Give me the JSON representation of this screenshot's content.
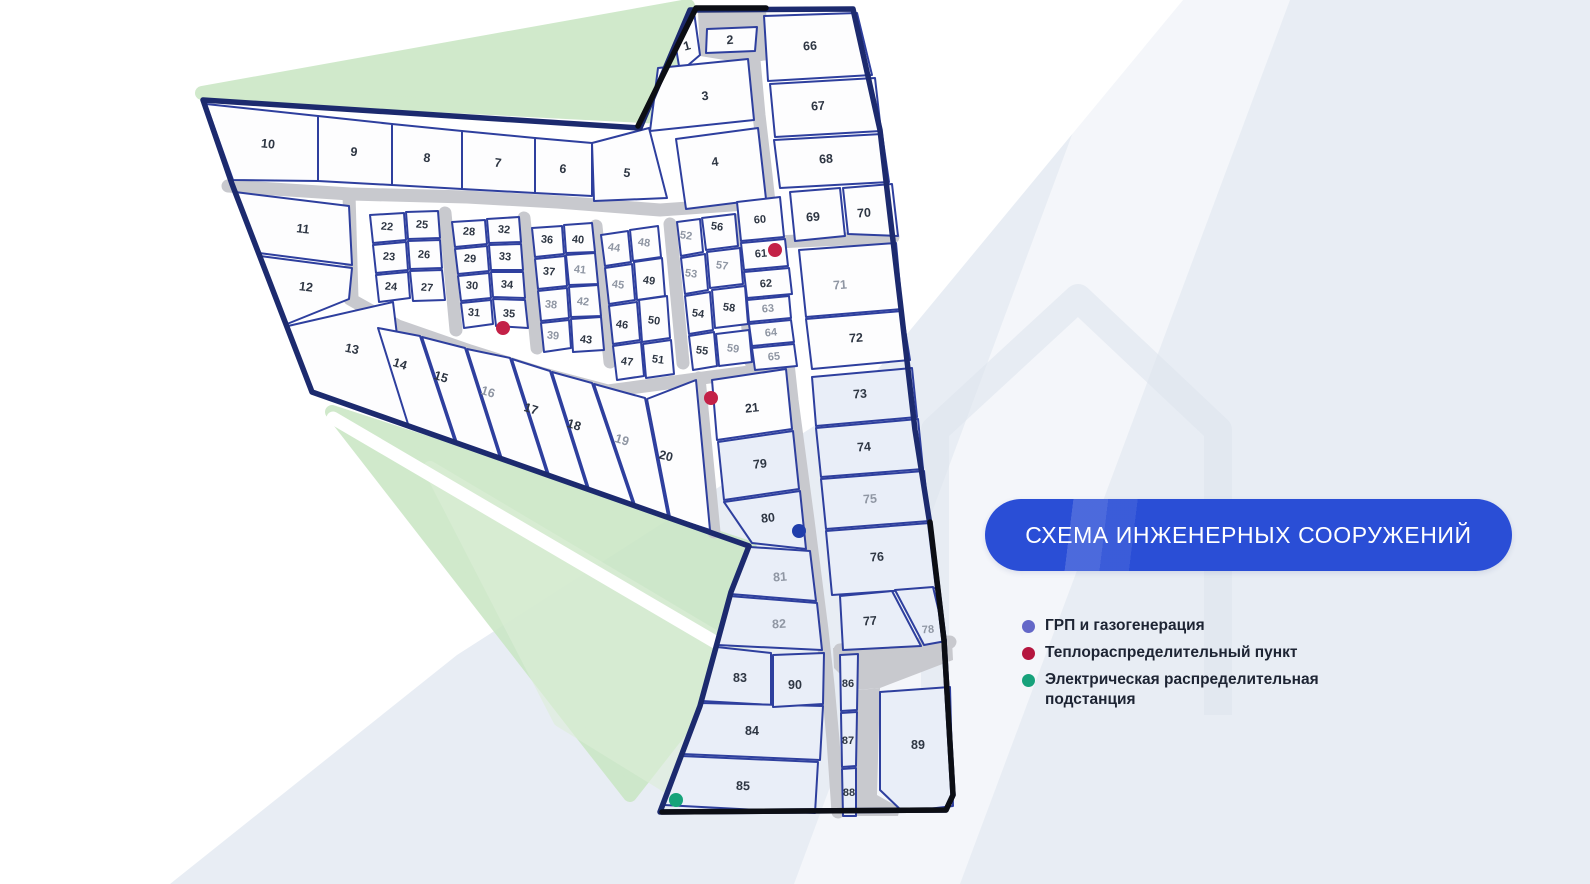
{
  "banner": {
    "text": "СХЕМА ИНЖЕНЕРНЫХ СООРУЖЕНИЙ",
    "background": "#2a4ed6",
    "text_color": "#ffffff"
  },
  "legend": {
    "items": [
      {
        "label": "ГРП и газогенерация",
        "color": "#6468c8",
        "dot_style": "background:#6468c8"
      },
      {
        "label": "Теплораспределительный пункт",
        "color": "#b5163f",
        "dot_style": "background:#b5163f"
      },
      {
        "label": "Электрическая распределительная подстанция",
        "color": "#17a27b",
        "dot_style": "background:#17a27b"
      }
    ]
  },
  "map": {
    "colors": {
      "plot_fill": "#fdfdfe",
      "plot_tint": "#e9eef8",
      "plot_stroke": "#2e3f9e",
      "road": "#c8c9ce",
      "boundary": "#1c2a6e",
      "black": "#0c0e14",
      "label": "#2e3643",
      "label_muted": "#8f96a3",
      "poi_red": "#c32147",
      "poi_blue": "#1f3dab",
      "poi_green": "#16a37a",
      "band_blue": "#e8edf4",
      "green_main": "#cbe7c6",
      "green_light": "#ddeed8",
      "watermark": "#dce3ed"
    },
    "background": {
      "bands": [
        {
          "name": "bg-band-right",
          "points": "1183,0 1590,0 1590,884 170,884 457,655 850,403",
          "fill": "#e8edf4",
          "opacity": 1
        },
        {
          "name": "bg-band-streak",
          "points": "1122,0 1290,0 960,884 794,884",
          "fill": "#ffffff",
          "opacity": 0.5
        }
      ],
      "watermark": {
        "d": "M935,715 L935,430 L1078,298 L1218,430 L1218,715",
        "opacity": 0.55,
        "width": 28
      },
      "greens": [
        {
          "name": "green-wedge-top",
          "points": "202,93 688,6 662,117",
          "fill": "#cbe7c6",
          "opacity": 0.9
        },
        {
          "name": "green-wedge-main",
          "points": "332,412 750,548 698,708 630,795 583,735",
          "fill": "#cbe7c6",
          "opacity": 0.9
        },
        {
          "name": "green-wedge-light",
          "points": "430,468 745,655 690,800 560,720",
          "fill": "#ddeed8",
          "opacity": 0.6
        }
      ],
      "streaks": [
        {
          "x1": 333,
          "y1": 418,
          "x2": 722,
          "y2": 646,
          "width": 13
        }
      ]
    },
    "roads": {
      "width": 13,
      "lines": [
        {
          "name": "road-top",
          "points": "228,186 350,194 467,197 557,202 660,210 760,203"
        },
        {
          "name": "road-main-vertical",
          "points": "750,12 754,60 759,115 766,175 772,230 779,290 786,345 792,400 800,460 808,520 815,575 822,630 828,685 833,740 838,812"
        },
        {
          "name": "road-spur-69-71",
          "points": "775,242 893,237"
        },
        {
          "name": "road-left-block",
          "points": "349,194 352,299"
        },
        {
          "name": "road-diagonal",
          "points": "350,299 398,326 470,351 540,373 608,391 660,384 710,377 788,367"
        },
        {
          "name": "road-20-21",
          "points": "699,378 714,532"
        },
        {
          "name": "road-block-a",
          "points": "445,213 456,330"
        },
        {
          "name": "road-block-b",
          "points": "524,218 537,348"
        },
        {
          "name": "road-block-c",
          "points": "596,226 610,362"
        },
        {
          "name": "road-block-d",
          "points": "670,224 683,363"
        },
        {
          "name": "road-block-e",
          "points": "738,220 751,362"
        },
        {
          "name": "road-spur-77",
          "points": "840,650 950,642"
        }
      ],
      "areas": [
        {
          "name": "road-area-plot2-loop",
          "points": "698,12 766,9 769,60 743,63 700,56"
        },
        {
          "name": "road-area-bottom-band",
          "points": "833,648 952,640 953,660 880,688 856,690 834,668"
        },
        {
          "name": "road-area-bottom-column",
          "points": "858,690 880,688 877,795 900,808 898,816 856,816"
        }
      ]
    },
    "boundary": {
      "points": "690,10 853,9 880,130 900,300 915,430 930,525 944,640 953,795 946,810 660,812 700,706 731,592 749,546 312,392 232,184 203,100 640,128",
      "width": 5.5
    },
    "black_segments": [
      {
        "name": "boundary-black-top",
        "points": "638,126 696,8 766,8"
      },
      {
        "name": "boundary-black-bottom",
        "points": "930,522 944,640 953,795 946,810 662,812"
      }
    ],
    "plots": [
      {
        "n": "1",
        "points": "675,42 694,12 700,55 680,72",
        "lx": 687,
        "ly": 46,
        "r": -15
      },
      {
        "n": "2",
        "points": "707,29 757,27 755,51 706,53",
        "lx": 730,
        "ly": 40,
        "r": -4
      },
      {
        "n": "3",
        "points": "658,68 748,59 754,120 650,131",
        "lx": 705,
        "ly": 96,
        "r": -6
      },
      {
        "n": "4",
        "points": "676,139 758,128 766,199 686,209",
        "lx": 715,
        "ly": 162,
        "r": -7
      },
      {
        "n": "5",
        "points": "592,143 649,128 667,198 594,201",
        "lx": 627,
        "ly": 173,
        "r": 7
      },
      {
        "n": "6",
        "points": "535,138 592,143 592,196 535,193",
        "lx": 563,
        "ly": 169,
        "r": 7
      },
      {
        "n": "7",
        "points": "462,131 535,138 535,193 462,189",
        "lx": 498,
        "ly": 163,
        "r": 7
      },
      {
        "n": "8",
        "points": "392,124 462,131 462,189 392,185",
        "lx": 427,
        "ly": 158,
        "r": 7
      },
      {
        "n": "9",
        "points": "318,116 392,124 392,185 318,181",
        "lx": 354,
        "ly": 152,
        "r": 7
      },
      {
        "n": "10",
        "points": "206,104 318,116 318,181 233,180",
        "lx": 268,
        "ly": 144,
        "r": 6
      },
      {
        "n": "11",
        "points": "235,192 349,206 352,265 259,253",
        "lx": 303,
        "ly": 229,
        "r": 7
      },
      {
        "n": "12",
        "points": "260,256 352,268 349,299 287,324",
        "lx": 306,
        "ly": 287,
        "r": 7
      },
      {
        "n": "13",
        "points": "288,326 393,302 408,426 313,393",
        "lx": 352,
        "ly": 349,
        "r": 12
      },
      {
        "n": "14",
        "points": "378,328 420,336 455,442 408,424",
        "lx": 400,
        "ly": 364,
        "r": 17
      },
      {
        "n": "15",
        "points": "422,337 465,348 500,458 457,443",
        "lx": 441,
        "ly": 377,
        "r": 17
      },
      {
        "n": "16",
        "points": "467,349 510,358 547,474 502,459",
        "lx": 488,
        "ly": 392,
        "r": 17,
        "muted": true
      },
      {
        "n": "17",
        "points": "512,359 550,371 587,488 549,475",
        "lx": 531,
        "ly": 409,
        "r": 17
      },
      {
        "n": "18",
        "points": "552,372 592,383 633,504 589,489",
        "lx": 574,
        "ly": 425,
        "r": 17
      },
      {
        "n": "19",
        "points": "594,384 645,398 668,516 635,505",
        "lx": 622,
        "ly": 440,
        "r": 17,
        "muted": true
      },
      {
        "n": "20",
        "points": "647,399 696,380 710,530 670,517",
        "lx": 666,
        "ly": 456,
        "r": 14
      },
      {
        "n": "21",
        "points": "712,380 786,369 792,429 717,440",
        "lx": 752,
        "ly": 408,
        "r": -6
      },
      {
        "n": "22",
        "points": "370,215 404,213 406,240 373,243",
        "lx": 387,
        "ly": 227,
        "r": 5,
        "fs": 11
      },
      {
        "n": "23",
        "points": "373,245 406,242 408,270 376,273",
        "lx": 389,
        "ly": 257,
        "r": 5,
        "fs": 11
      },
      {
        "n": "24",
        "points": "376,275 408,272 410,298 379,302",
        "lx": 391,
        "ly": 287,
        "r": 5,
        "fs": 11
      },
      {
        "n": "25",
        "points": "406,212 438,211 440,238 408,239",
        "lx": 422,
        "ly": 225,
        "r": 5,
        "fs": 11
      },
      {
        "n": "26",
        "points": "408,241 440,240 442,268 410,269",
        "lx": 424,
        "ly": 255,
        "r": 5,
        "fs": 11
      },
      {
        "n": "27",
        "points": "410,271 442,270 445,300 413,301",
        "lx": 427,
        "ly": 288,
        "r": 5,
        "fs": 11
      },
      {
        "n": "28",
        "points": "452,222 485,220 487,244 455,247",
        "lx": 469,
        "ly": 232,
        "r": 5,
        "fs": 11
      },
      {
        "n": "29",
        "points": "455,249 487,246 489,271 458,274",
        "lx": 470,
        "ly": 259,
        "r": 5,
        "fs": 11
      },
      {
        "n": "30",
        "points": "458,276 489,273 491,298 461,301",
        "lx": 472,
        "ly": 286,
        "r": 5,
        "fs": 11
      },
      {
        "n": "31",
        "points": "461,303 491,300 493,324 464,328",
        "lx": 474,
        "ly": 313,
        "r": 5,
        "fs": 11
      },
      {
        "n": "32",
        "points": "487,219 519,217 521,242 489,243",
        "lx": 504,
        "ly": 230,
        "r": 5,
        "fs": 11
      },
      {
        "n": "33",
        "points": "489,245 521,244 523,270 491,270",
        "lx": 505,
        "ly": 257,
        "r": 5,
        "fs": 11
      },
      {
        "n": "34",
        "points": "491,272 523,272 525,298 493,297",
        "lx": 507,
        "ly": 285,
        "r": 5,
        "fs": 11
      },
      {
        "n": "35",
        "points": "493,299 525,300 528,328 496,326",
        "lx": 509,
        "ly": 314,
        "r": 5,
        "fs": 11
      },
      {
        "n": "36",
        "points": "532,228 562,226 564,254 535,257",
        "lx": 547,
        "ly": 240,
        "r": 6,
        "fs": 11
      },
      {
        "n": "37",
        "points": "535,259 565,256 567,286 538,289",
        "lx": 549,
        "ly": 272,
        "r": 6,
        "fs": 11
      },
      {
        "n": "38",
        "points": "538,291 567,288 569,318 541,321",
        "lx": 551,
        "ly": 305,
        "r": 6,
        "fs": 11,
        "muted": true
      },
      {
        "n": "39",
        "points": "541,323 569,320 571,348 544,352",
        "lx": 553,
        "ly": 336,
        "r": 6,
        "fs": 11,
        "muted": true
      },
      {
        "n": "40",
        "points": "564,225 592,223 595,252 566,253",
        "lx": 578,
        "ly": 240,
        "r": 6,
        "fs": 11
      },
      {
        "n": "41",
        "points": "566,255 595,253 598,284 569,285",
        "lx": 580,
        "ly": 270,
        "r": 6,
        "fs": 11,
        "muted": true
      },
      {
        "n": "42",
        "points": "569,287 598,285 601,316 571,317",
        "lx": 583,
        "ly": 302,
        "r": 6,
        "fs": 11,
        "muted": true
      },
      {
        "n": "43",
        "points": "571,319 601,317 604,350 573,352",
        "lx": 586,
        "ly": 340,
        "r": 6,
        "fs": 11
      },
      {
        "n": "44",
        "points": "601,235 628,231 631,262 605,266",
        "lx": 614,
        "ly": 248,
        "r": 8,
        "fs": 11,
        "muted": true
      },
      {
        "n": "45",
        "points": "605,268 632,264 635,300 609,304",
        "lx": 618,
        "ly": 285,
        "r": 8,
        "fs": 11,
        "muted": true
      },
      {
        "n": "46",
        "points": "609,306 637,302 640,340 613,344",
        "lx": 622,
        "ly": 325,
        "r": 8,
        "fs": 11
      },
      {
        "n": "47",
        "points": "613,346 641,342 644,376 617,380",
        "lx": 627,
        "ly": 362,
        "r": 8,
        "fs": 11
      },
      {
        "n": "48",
        "points": "630,230 658,226 661,257 633,261",
        "lx": 644,
        "ly": 243,
        "r": 8,
        "fs": 11,
        "muted": true
      },
      {
        "n": "49",
        "points": "634,262 662,258 665,296 637,300",
        "lx": 649,
        "ly": 281,
        "r": 8,
        "fs": 11
      },
      {
        "n": "50",
        "points": "639,300 667,296 670,338 642,342",
        "lx": 654,
        "ly": 321,
        "r": 8,
        "fs": 11
      },
      {
        "n": "51",
        "points": "643,344 671,340 674,374 646,378",
        "lx": 658,
        "ly": 360,
        "r": 8,
        "fs": 11
      },
      {
        "n": "52",
        "points": "677,222 700,219 703,252 681,256",
        "lx": 686,
        "ly": 236,
        "r": 8,
        "fs": 11,
        "muted": true
      },
      {
        "n": "53",
        "points": "681,258 705,254 708,290 685,294",
        "lx": 691,
        "ly": 274,
        "r": 8,
        "fs": 11,
        "muted": true
      },
      {
        "n": "54",
        "points": "685,296 710,292 713,330 689,334",
        "lx": 698,
        "ly": 314,
        "r": 8,
        "fs": 11
      },
      {
        "n": "55",
        "points": "689,336 714,332 717,366 693,370",
        "lx": 702,
        "ly": 351,
        "r": 8,
        "fs": 11
      },
      {
        "n": "56",
        "points": "702,218 735,214 738,246 706,250",
        "lx": 717,
        "ly": 227,
        "r": 8,
        "fs": 11
      },
      {
        "n": "57",
        "points": "707,252 740,248 743,284 710,288",
        "lx": 722,
        "ly": 266,
        "r": 8,
        "fs": 11,
        "muted": true
      },
      {
        "n": "58",
        "points": "712,290 745,286 748,324 715,328",
        "lx": 729,
        "ly": 308,
        "r": 8,
        "fs": 11
      },
      {
        "n": "59",
        "points": "716,334 749,330 752,362 719,366",
        "lx": 733,
        "ly": 349,
        "r": 8,
        "fs": 11,
        "muted": true
      },
      {
        "n": "60",
        "points": "737,202 780,197 784,237 741,241",
        "lx": 760,
        "ly": 220,
        "r": -5,
        "fs": 11
      },
      {
        "n": "61",
        "points": "741,243 785,239 788,266 744,270",
        "lx": 761,
        "ly": 254,
        "r": -5,
        "fs": 11
      },
      {
        "n": "62",
        "points": "744,272 789,268 792,294 747,298",
        "lx": 766,
        "ly": 284,
        "r": -5,
        "fs": 11
      },
      {
        "n": "63",
        "points": "747,300 789,296 791,318 749,322",
        "lx": 768,
        "ly": 309,
        "r": -5,
        "fs": 11,
        "muted": true
      },
      {
        "n": "64",
        "points": "749,324 791,320 794,342 752,346",
        "lx": 771,
        "ly": 333,
        "r": -5,
        "fs": 11,
        "muted": true
      },
      {
        "n": "65",
        "points": "752,348 794,344 797,366 755,370",
        "lx": 774,
        "ly": 357,
        "r": -5,
        "fs": 11,
        "muted": true
      },
      {
        "n": "66",
        "points": "764,16 857,13 872,75 768,81",
        "lx": 810,
        "ly": 46,
        "r": -3
      },
      {
        "n": "67",
        "points": "770,84 875,78 881,131 775,137",
        "lx": 818,
        "ly": 106,
        "r": -4
      },
      {
        "n": "68",
        "points": "774,140 882,134 889,182 780,188",
        "lx": 826,
        "ly": 159,
        "r": -4
      },
      {
        "n": "69",
        "points": "790,192 840,188 845,236 795,241",
        "lx": 813,
        "ly": 217,
        "r": -4
      },
      {
        "n": "70",
        "points": "843,188 892,184 898,236 848,234",
        "lx": 864,
        "ly": 213,
        "r": -4
      },
      {
        "n": "71",
        "points": "799,250 896,243 902,309 806,317",
        "lx": 840,
        "ly": 285,
        "r": -4,
        "muted": true
      },
      {
        "n": "72",
        "points": "806,319 902,311 910,360 812,369",
        "lx": 856,
        "ly": 338,
        "r": -4
      },
      {
        "n": "73",
        "points": "812,377 912,368 917,417 816,426",
        "lx": 860,
        "ly": 394,
        "r": -4,
        "tint": true
      },
      {
        "n": "74",
        "points": "816,428 918,419 923,469 821,477",
        "lx": 864,
        "ly": 447,
        "r": -4,
        "tint": true
      },
      {
        "n": "75",
        "points": "821,479 924,471 929,521 826,529",
        "lx": 870,
        "ly": 499,
        "r": -4,
        "tint": true,
        "muted": true
      },
      {
        "n": "76",
        "points": "826,531 930,523 937,588 832,595",
        "lx": 877,
        "ly": 557,
        "r": -4,
        "tint": true
      },
      {
        "n": "77",
        "points": "840,596 892,591 921,646 843,650",
        "lx": 870,
        "ly": 621,
        "r": -4,
        "tint": true
      },
      {
        "n": "78",
        "points": "895,590 933,587 946,641 924,645",
        "lx": 928,
        "ly": 630,
        "r": -4,
        "tint": true,
        "muted": true,
        "fs": 11
      },
      {
        "n": "79",
        "points": "718,442 793,431 799,489 724,500",
        "lx": 760,
        "ly": 464,
        "r": -6,
        "tint": true
      },
      {
        "n": "80",
        "points": "724,502 800,491 806,549 752,543",
        "lx": 768,
        "ly": 518,
        "r": -6,
        "tint": true
      },
      {
        "n": "81",
        "points": "750,547 810,551 816,601 730,594",
        "lx": 780,
        "ly": 577,
        "r": -4,
        "tint": true,
        "muted": true
      },
      {
        "n": "82",
        "points": "729,596 817,603 822,650 717,645",
        "lx": 779,
        "ly": 624,
        "r": -3,
        "tint": true,
        "muted": true
      },
      {
        "n": "83",
        "points": "717,647 771,653 771,705 702,701",
        "lx": 740,
        "ly": 678,
        "r": 0,
        "tint": true
      },
      {
        "n": "84",
        "points": "701,703 823,706 820,760 682,754",
        "lx": 752,
        "ly": 731,
        "r": 0,
        "tint": true
      },
      {
        "n": "85",
        "points": "681,756 818,762 815,813 664,805",
        "lx": 743,
        "ly": 786,
        "r": 2,
        "tint": true
      },
      {
        "n": "86",
        "points": "840,655 858,654 857,710 841,711",
        "lx": 848,
        "ly": 684,
        "r": 0,
        "tint": true,
        "fs": 11
      },
      {
        "n": "87",
        "points": "841,713 857,712 856,766 842,767",
        "lx": 848,
        "ly": 741,
        "r": 0,
        "tint": true,
        "fs": 11
      },
      {
        "n": "88",
        "points": "842,769 856,768 856,816 843,816",
        "lx": 849,
        "ly": 793,
        "r": 0,
        "tint": true,
        "fs": 11
      },
      {
        "n": "89",
        "points": "880,692 950,687 953,806 903,812 880,790",
        "lx": 918,
        "ly": 745,
        "r": 0,
        "tint": true
      },
      {
        "n": "90",
        "points": "773,655 824,653 823,704 773,707",
        "lx": 795,
        "ly": 685,
        "r": 0,
        "tint": true
      }
    ],
    "poi": [
      {
        "kind": "red",
        "name": "poi-heat-point-35",
        "x": 503,
        "y": 328,
        "r": 7
      },
      {
        "kind": "red",
        "name": "poi-heat-point-61",
        "x": 775,
        "y": 250,
        "r": 7
      },
      {
        "kind": "red",
        "name": "poi-heat-point-21",
        "x": 711,
        "y": 398,
        "r": 7
      },
      {
        "kind": "blue",
        "name": "poi-gas-point-80",
        "x": 799,
        "y": 531,
        "r": 7
      },
      {
        "kind": "green",
        "name": "poi-substation-85",
        "x": 676,
        "y": 800,
        "r": 7
      }
    ]
  }
}
